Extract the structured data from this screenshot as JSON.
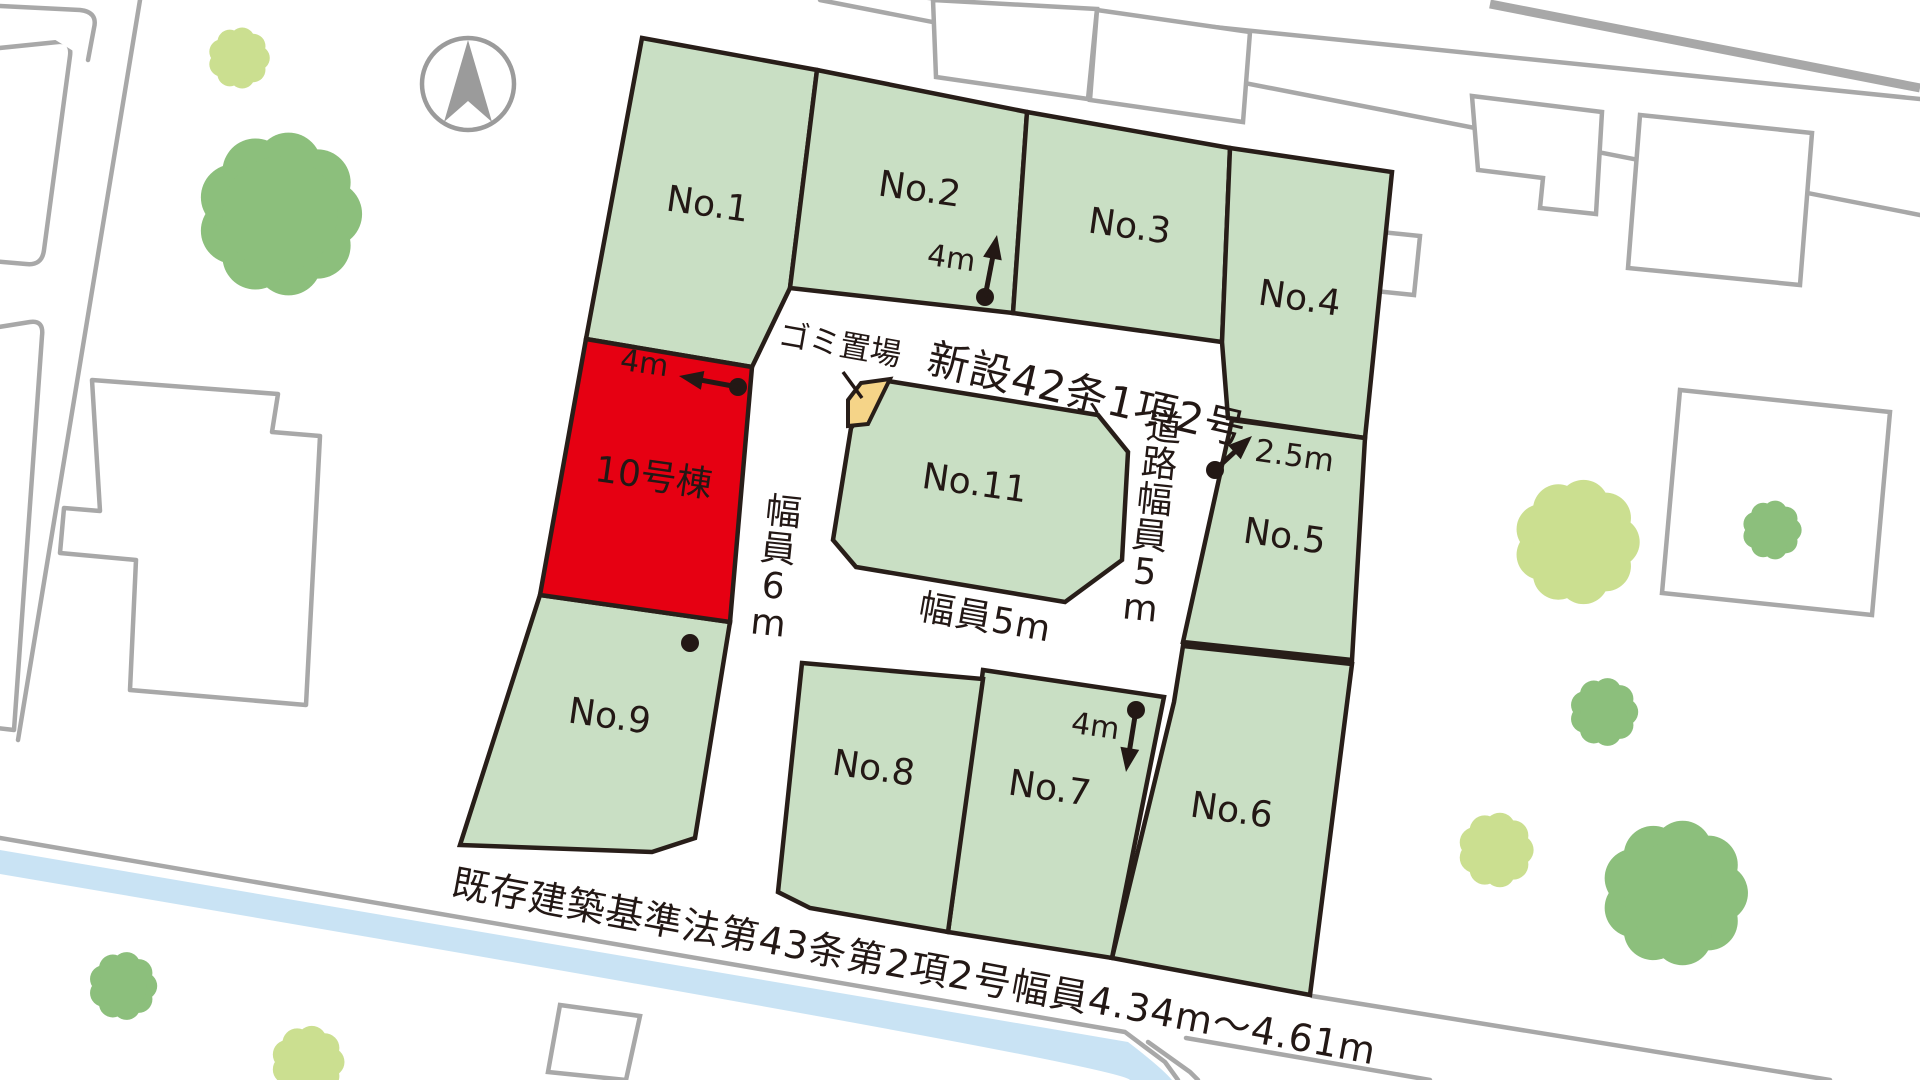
{
  "canvas": {
    "width": 1920,
    "height": 1080
  },
  "colors": {
    "lot_green": "#c9dfc4",
    "lot_stroke": "#281e19",
    "highlight_red": "#e60012",
    "garbage_tan": "#f5d488",
    "bg_gray": "#a8a8a8",
    "water_blue": "#c9e3f4",
    "tree_green": "#8cbf7c",
    "tree_yellow_green": "#cbdf90",
    "text_dark": "#231815",
    "compass_gray": "#9b9b9b"
  },
  "compass": {
    "cx": 468,
    "cy": 84,
    "r": 46
  },
  "lots": [
    {
      "id": "no1",
      "label": "No.1",
      "fill": "green",
      "polygon": [
        [
          642,
          38
        ],
        [
          817,
          70
        ],
        [
          790,
          288
        ],
        [
          752,
          367
        ],
        [
          586,
          339
        ]
      ],
      "label_pos": [
        706,
        216
      ],
      "label_rot": 8,
      "font": 36
    },
    {
      "id": "no2",
      "label": "No.2",
      "fill": "green",
      "polygon": [
        [
          817,
          70
        ],
        [
          1027,
          112
        ],
        [
          1013,
          313
        ],
        [
          790,
          288
        ]
      ],
      "label_pos": [
        918,
        201
      ],
      "label_rot": 8,
      "font": 36
    },
    {
      "id": "no3",
      "label": "No.3",
      "fill": "green",
      "polygon": [
        [
          1027,
          112
        ],
        [
          1230,
          148
        ],
        [
          1222,
          342
        ],
        [
          1013,
          313
        ]
      ],
      "label_pos": [
        1128,
        238
      ],
      "label_rot": 8,
      "font": 36
    },
    {
      "id": "no4",
      "label": "No.4",
      "fill": "green",
      "polygon": [
        [
          1230,
          148
        ],
        [
          1392,
          172
        ],
        [
          1365,
          438
        ],
        [
          1228,
          418
        ],
        [
          1222,
          342
        ]
      ],
      "label_pos": [
        1298,
        310
      ],
      "label_rot": 8,
      "font": 36
    },
    {
      "id": "no5",
      "label": "No.5",
      "fill": "green",
      "polygon": [
        [
          1232,
          420
        ],
        [
          1365,
          438
        ],
        [
          1352,
          660
        ],
        [
          1183,
          642
        ]
      ],
      "label_pos": [
        1283,
        548
      ],
      "label_rot": 8,
      "font": 36
    },
    {
      "id": "no6",
      "label": "No.6",
      "fill": "green",
      "polygon": [
        [
          1183,
          646
        ],
        [
          1352,
          664
        ],
        [
          1310,
          995
        ],
        [
          1112,
          958
        ],
        [
          1174,
          702
        ]
      ],
      "label_pos": [
        1230,
        822
      ],
      "label_rot": 8,
      "font": 36
    },
    {
      "id": "no7",
      "label": "No.7",
      "fill": "green",
      "polygon": [
        [
          983,
          670
        ],
        [
          1164,
          697
        ],
        [
          1112,
          958
        ],
        [
          948,
          932
        ]
      ],
      "label_pos": [
        1048,
        800
      ],
      "label_rot": 8,
      "font": 36
    },
    {
      "id": "no8",
      "label": "No.8",
      "fill": "green",
      "polygon": [
        [
          802,
          663
        ],
        [
          983,
          679
        ],
        [
          948,
          932
        ],
        [
          810,
          908
        ],
        [
          778,
          892
        ]
      ],
      "label_pos": [
        872,
        780
      ],
      "label_rot": 8,
      "font": 36
    },
    {
      "id": "no9",
      "label": "No.9",
      "fill": "green",
      "polygon": [
        [
          540,
          595
        ],
        [
          730,
          622
        ],
        [
          695,
          838
        ],
        [
          652,
          852
        ],
        [
          460,
          845
        ]
      ],
      "label_pos": [
        608,
        728
      ],
      "label_rot": 8,
      "font": 36
    },
    {
      "id": "no10",
      "label": "10号棟",
      "fill": "red",
      "polygon": [
        [
          586,
          339
        ],
        [
          752,
          367
        ],
        [
          730,
          622
        ],
        [
          540,
          595
        ]
      ],
      "label_pos": [
        652,
        489
      ],
      "label_rot": 8,
      "font": 36
    },
    {
      "id": "no11",
      "label": "No.11",
      "fill": "green",
      "polygon": [
        [
          888,
          381
        ],
        [
          1098,
          415
        ],
        [
          1128,
          452
        ],
        [
          1122,
          560
        ],
        [
          1065,
          602
        ],
        [
          856,
          567
        ],
        [
          833,
          540
        ],
        [
          851,
          428
        ]
      ],
      "label_pos": [
        973,
        495
      ],
      "label_rot": 8,
      "font": 36
    }
  ],
  "garbage": {
    "label": "ゴミ置場",
    "label_pos": [
      838,
      355
    ],
    "label_rot": 10,
    "font": 31,
    "polygon": [
      [
        848,
        400
      ],
      [
        861,
        383
      ],
      [
        890,
        379
      ],
      [
        868,
        424
      ],
      [
        848,
        426
      ]
    ],
    "leader": [
      [
        843,
        372
      ],
      [
        862,
        398
      ]
    ]
  },
  "road_labels": [
    {
      "id": "new-road-name",
      "text": "新設42条1項2号",
      "x": 925,
      "y": 372,
      "rot": 13,
      "font": 42,
      "anchor": "start",
      "vertical": false
    },
    {
      "id": "road-width-5m-vertical",
      "text": "道路幅員5m",
      "x": 1163,
      "y": 440,
      "rot": 0,
      "font": 36,
      "anchor": "middle",
      "vertical": true,
      "step": 36,
      "drift": -4.8
    },
    {
      "id": "road-width-6m-vertical",
      "text": "幅員6m",
      "x": 782,
      "y": 524,
      "rot": 0,
      "font": 36,
      "anchor": "middle",
      "vertical": true,
      "step": 37,
      "drift": -5
    },
    {
      "id": "road-width-5m-horizontal",
      "text": "幅員5m",
      "x": 983,
      "y": 630,
      "rot": 10,
      "font": 36,
      "anchor": "middle",
      "vertical": false
    },
    {
      "id": "existing-road-note",
      "text": "既存建築基準法第43条第2項2号幅員4.34m〜4.61m",
      "x": 450,
      "y": 895,
      "rot": 10.4,
      "font": 38,
      "anchor": "start",
      "vertical": false
    }
  ],
  "annotations": [
    {
      "id": "width-4m-north",
      "text": "4m",
      "text_pos": [
        950,
        268
      ],
      "rot": 8,
      "font": 30,
      "dot": [
        985,
        297
      ],
      "tip": [
        997,
        235
      ]
    },
    {
      "id": "width-4m-west",
      "text": "4m",
      "text_pos": [
        643,
        373
      ],
      "rot": 8,
      "font": 30,
      "dot": [
        738,
        387
      ],
      "tip": [
        679,
        376
      ]
    },
    {
      "id": "width-2-5m",
      "text": "2.5m",
      "text_pos": [
        1293,
        466
      ],
      "rot": 8,
      "font": 31,
      "dot": [
        1215,
        470
      ],
      "tip": [
        1252,
        436
      ]
    },
    {
      "id": "width-4m-south",
      "text": "4m",
      "text_pos": [
        1094,
        736
      ],
      "rot": 8,
      "font": 30,
      "dot": [
        1136,
        710
      ],
      "tip": [
        1126,
        772
      ]
    }
  ],
  "extra_dots": [
    [
      690,
      643
    ]
  ],
  "background": {
    "road_lines": [
      [
        [
          140,
          0
        ],
        [
          18,
          740
        ]
      ],
      [
        [
          900,
          -5
        ],
        [
          1920,
          99
        ]
      ],
      [
        [
          820,
          0
        ],
        [
          1920,
          215
        ]
      ],
      [
        [
          0,
          838
        ],
        [
          1125,
          1032
        ],
        [
          1165,
          1062
        ],
        [
          1178,
          1080
        ]
      ],
      [
        [
          1312,
          996
        ],
        [
          1830,
          1080
        ]
      ],
      [
        [
          1148,
          1042
        ],
        [
          1190,
          1072
        ],
        [
          1198,
          1080
        ]
      ],
      [
        [
          1186,
          1038
        ],
        [
          1430,
          1080
        ]
      ]
    ],
    "thick_line": [
      [
        1490,
        4
      ],
      [
        1920,
        88
      ]
    ],
    "buildings": [
      [
        [
          933,
          0
        ],
        [
          1097,
          9
        ],
        [
          1088,
          99
        ],
        [
          936,
          77
        ]
      ],
      [
        [
          1097,
          10
        ],
        [
          1250,
          32
        ],
        [
          1243,
          122
        ],
        [
          1090,
          100
        ]
      ],
      [
        [
          1472,
          96
        ],
        [
          1602,
          112
        ],
        [
          1596,
          214
        ],
        [
          1540,
          208
        ],
        [
          1543,
          178
        ],
        [
          1478,
          170
        ]
      ],
      [
        [
          1640,
          115
        ],
        [
          1812,
          133
        ],
        [
          1800,
          285
        ],
        [
          1628,
          268
        ]
      ],
      [
        [
          1362,
          230
        ],
        [
          1420,
          236
        ],
        [
          1414,
          295
        ],
        [
          1356,
          289
        ]
      ],
      [
        [
          1680,
          390
        ],
        [
          1890,
          412
        ],
        [
          1872,
          615
        ],
        [
          1662,
          593
        ]
      ],
      [
        [
          560,
          1005
        ],
        [
          640,
          1016
        ],
        [
          626,
          1080
        ],
        [
          548,
          1072
        ]
      ]
    ],
    "parcel_paths": [
      "M -20,50 L 58,42 Q 72,41 70,56 L 44,250 Q 42,266 26,264 L -20,260 Z",
      "M -20,330 L 30,322 Q 44,320 42,336 L 14,730 L -20,726 Z",
      "M 92,380 L 278,394 L 272,432 L 320,436 L 306,705 L 130,690 L 136,560 L 60,553 L 64,508 L 100,511 Z",
      "M 0,6 L 80,10 Q 98,12 94,28 L 88,60"
    ],
    "water_path": "M 0,850 L 1128,1042 Q 1162,1068 1172,1080 L 1130,1080 Q 1118,1064 0,874 Z",
    "trees": [
      {
        "cx": 239,
        "cy": 58,
        "r": 27,
        "tone": "yellow_green"
      },
      {
        "cx": 280,
        "cy": 214,
        "r": 72,
        "tone": "green"
      },
      {
        "cx": 123,
        "cy": 986,
        "r": 30,
        "tone": "green"
      },
      {
        "cx": 308,
        "cy": 1062,
        "r": 32,
        "tone": "yellow_green"
      },
      {
        "cx": 1577,
        "cy": 542,
        "r": 55,
        "tone": "yellow_green"
      },
      {
        "cx": 1772,
        "cy": 530,
        "r": 26,
        "tone": "green"
      },
      {
        "cx": 1604,
        "cy": 712,
        "r": 30,
        "tone": "green"
      },
      {
        "cx": 1496,
        "cy": 850,
        "r": 33,
        "tone": "yellow_green"
      },
      {
        "cx": 1675,
        "cy": 893,
        "r": 64,
        "tone": "green"
      }
    ]
  }
}
